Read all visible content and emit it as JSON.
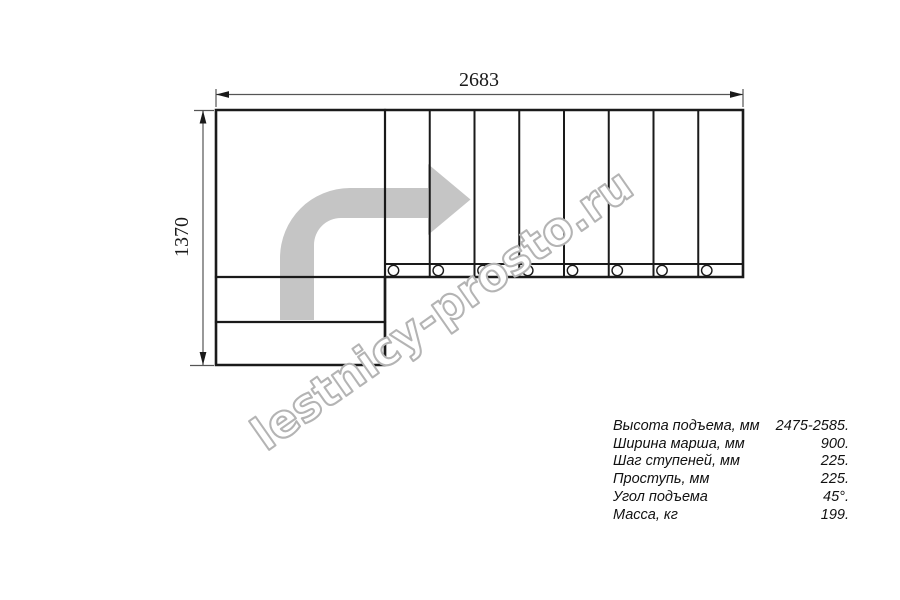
{
  "drawing": {
    "title": "stair-plan-top-view",
    "top_dimension": "2683",
    "left_dimension": "1370",
    "watermark": "lestnicy-prosto.ru",
    "tread_count": 8,
    "colors": {
      "line": "#1a1a1a",
      "dimension_line": "#555555",
      "arrow_fill": "#c5c5c5",
      "watermark_outline": "#b4b4b4",
      "background": "#ffffff"
    }
  },
  "specs": {
    "rows": [
      {
        "label": "Высота подъема, мм",
        "value": "2475-2585."
      },
      {
        "label": "Ширина марша, мм",
        "value": "900."
      },
      {
        "label": "Шаг ступеней, мм",
        "value": "225."
      },
      {
        "label": "Проступь, мм",
        "value": "225."
      },
      {
        "label": "Угол подъема",
        "value": "45°."
      },
      {
        "label": "Масса, кг",
        "value": "199."
      }
    ]
  }
}
